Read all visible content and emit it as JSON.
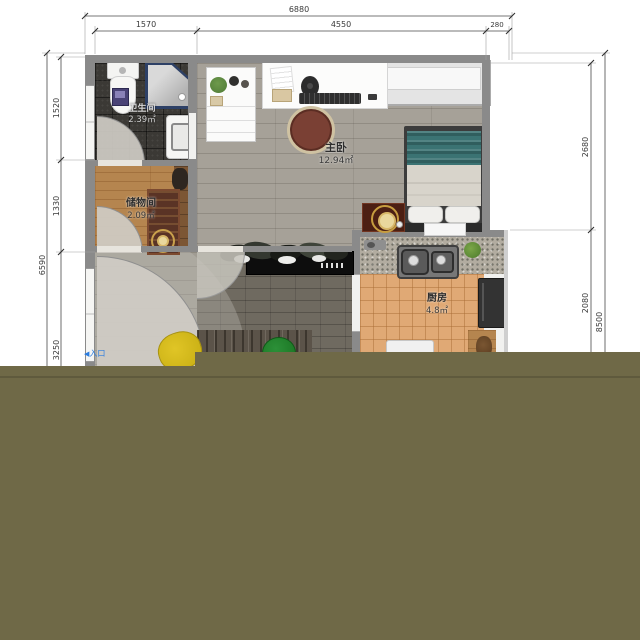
{
  "dimensions": {
    "top": {
      "total": "6880",
      "seg1": "1570",
      "seg2": "4550",
      "seg3": "280"
    },
    "left": {
      "total": "6590",
      "seg1": "1520",
      "seg2": "1330",
      "seg3": "3250"
    },
    "right": {
      "total": "8500",
      "seg1": "2680",
      "seg2": "2080"
    }
  },
  "rooms": {
    "bathroom": {
      "name": "卫生间",
      "area": "2.39㎡"
    },
    "storage": {
      "name": "储物间",
      "area": "2.09㎡"
    },
    "bedroom": {
      "name": "主卧",
      "area": "12.94㎡"
    },
    "kitchen": {
      "name": "厨房",
      "area": "4.8㎡"
    }
  },
  "entrance": {
    "arrow": "◀",
    "label": "入口"
  },
  "colors": {
    "overlay_olive": "#6f6947",
    "entrance_blue": "#2b7de0",
    "bed_blanket_teal": "#3b7373",
    "chair_yellow": "#d2b71b",
    "chair_green": "#1f7d2d",
    "desk_chair_maroon": "#7a4034"
  }
}
